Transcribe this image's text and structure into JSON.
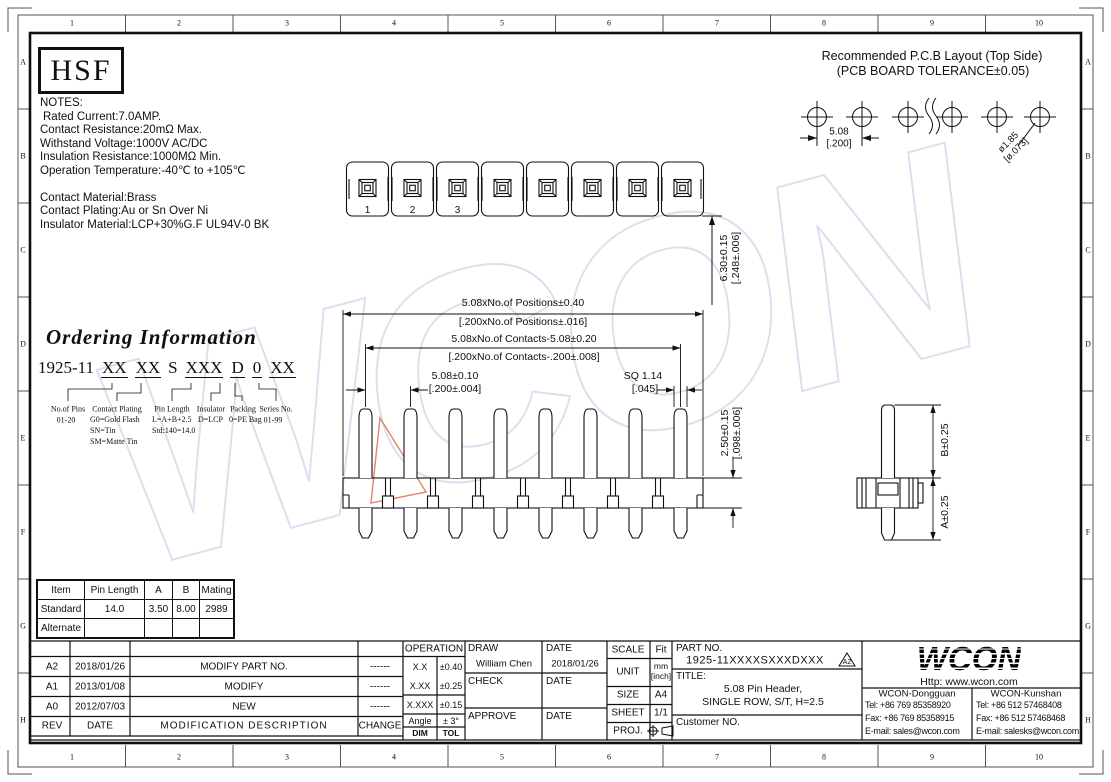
{
  "colors": {
    "line": "#101010",
    "watermark": "#b7b7db",
    "triangle": "#e08565"
  },
  "frame": {
    "top": [
      "1",
      "2",
      "3",
      "4",
      "5",
      "6",
      "7",
      "8",
      "9",
      "10"
    ],
    "bottom": [
      "1",
      "2",
      "3",
      "4",
      "5",
      "6",
      "7",
      "8",
      "9",
      "10"
    ],
    "left": [
      "A",
      "B",
      "C",
      "D",
      "E",
      "F",
      "G",
      "H"
    ],
    "right": [
      "A",
      "B",
      "C",
      "D",
      "E",
      "F",
      "G",
      "H"
    ]
  },
  "logo": {
    "hsf": "HSF"
  },
  "pcb_layout": {
    "title_line1": "Recommended P.C.B Layout (Top Side)",
    "title_line2": "(PCB BOARD TOLERANCE±0.05)",
    "pitch_mm": "5.08",
    "pitch_inch": "[.200]",
    "hole_dia": "ø1.85",
    "hole_dia_inch": "[ø.073]"
  },
  "notes": {
    "heading": "NOTES:",
    "lines": [
      "Rated Current:7.0AMP.",
      "Contact Resistance:20mΩ Max.",
      "Withstand Voltage:1000V AC/DC",
      "Insulation Resistance:1000MΩ Min.",
      "Operation Temperature:-40℃ to +105℃"
    ],
    "material_lines": [
      "Contact Material:Brass",
      "Contact Plating:Au or Sn Over Ni",
      "Insulator Material:LCP+30%G.F UL94V-0 BK"
    ]
  },
  "ordering": {
    "title": "Ordering Information",
    "part": [
      "1925-11",
      "XX",
      "XX",
      "S",
      "XXX",
      "D",
      "0",
      "XX"
    ],
    "callouts": [
      {
        "label": "No.of Pins",
        "values": [
          "01-20"
        ]
      },
      {
        "label": "Contact Plating",
        "values": [
          "G0=Gold Flash",
          "SN=Tin",
          "SM=Matte Tin"
        ]
      },
      {
        "label": "Pin Length",
        "values": [
          "L=A+B+2.5",
          "Std:140=14.0"
        ]
      },
      {
        "label": "Insulator",
        "values": [
          "D=LCP"
        ]
      },
      {
        "label": "Packing",
        "values": [
          "0=PE Bag"
        ]
      },
      {
        "label": "Series No.",
        "values": [
          "01-99"
        ]
      }
    ]
  },
  "top_view": {
    "pins": [
      "1",
      "2",
      "3"
    ]
  },
  "dims": {
    "positions_mm": "5.08xNo.of Positions±0.40",
    "positions_inch": "[.200xNo.of Positions±.016]",
    "contacts_mm": "5.08xNo.of Contacts-5.08±0.20",
    "contacts_inch": "[.200xNo.of Contacts-.200±.008]",
    "pitch_mm": "5.08±0.10",
    "pitch_inch": "[.200±.004]",
    "sq": "SQ 1.14",
    "sq_inch": "[.045]",
    "height_mm": "6.30±0.15",
    "height_inch": "[.248±.006]",
    "standoff_mm": "2.50±0.15",
    "standoff_inch": "[.098±.006]",
    "b_dim": "B±0.25",
    "a_dim": "A±0.25"
  },
  "spec_table": {
    "headers": [
      "Item",
      "Pin Length",
      "A",
      "B",
      "Mating"
    ],
    "rows": [
      [
        "Standard",
        "14.0",
        "3.50",
        "8.00",
        "2989"
      ],
      [
        "Alternate",
        "",
        "",
        "",
        ""
      ]
    ]
  },
  "revisions": {
    "headers": {
      "rev": "REV",
      "date": "DATE",
      "desc": "MODIFICATION  DESCRIPTION",
      "change": "CHANGE"
    },
    "rows": [
      {
        "rev": "A2",
        "date": "2018/01/26",
        "desc": "MODIFY  PART  NO.",
        "change": "------"
      },
      {
        "rev": "A1",
        "date": "2013/01/08",
        "desc": "MODIFY",
        "change": "------"
      },
      {
        "rev": "A0",
        "date": "2012/07/03",
        "desc": "NEW",
        "change": "------"
      }
    ]
  },
  "tolerances": {
    "header": "OPERATION",
    "rows": [
      [
        "X.X",
        "±0.40"
      ],
      [
        "X.XX",
        "±0.25"
      ],
      [
        "X.XXX",
        "±0.15"
      ],
      [
        "Angle",
        "± 3°"
      ]
    ],
    "footer": [
      "DIM",
      "TOL"
    ]
  },
  "approval": {
    "draw_label": "DRAW",
    "draw_name": "William Chen",
    "draw_date_label": "DATE",
    "draw_date": "2018/01/26",
    "check_label": "CHECK",
    "check_date_label": "DATE",
    "approve_label": "APPROVE",
    "approve_date_label": "DATE"
  },
  "doc_info": {
    "scale_label": "SCALE",
    "scale": "Fit",
    "unit_label": "UNIT",
    "unit_mm": "mm",
    "unit_inch": "[inch]",
    "size_label": "SIZE",
    "size": "A4",
    "sheet_label": "SHEET",
    "sheet": "1/1",
    "proj_label": "PROJ."
  },
  "part": {
    "part_no_label": "PART NO.",
    "part_no": "1925-11XXXXSXXXDXXX",
    "rev_flag": "A2",
    "title_label": "TITLE:",
    "title_line1": "5.08 Pin Header,",
    "title_line2": "SINGLE ROW, S/T, H=2.5",
    "customer_label": "Customer NO."
  },
  "company": {
    "logo": "WCON",
    "website": "Http: www.wcon.com",
    "offices": [
      {
        "name": "WCON-Dongguan",
        "tel": "Tel: +86 769 85358920",
        "fax": "Fax: +86 769 85358915",
        "email": "E-mail: sales@wcon.com"
      },
      {
        "name": "WCON-Kunshan",
        "tel": "Tel: +86 512 57468408",
        "fax": "Fax: +86 512 57468468",
        "email": "E-mail: salesks@wcon.com"
      }
    ]
  },
  "watermark": {
    "text": "WCON"
  }
}
